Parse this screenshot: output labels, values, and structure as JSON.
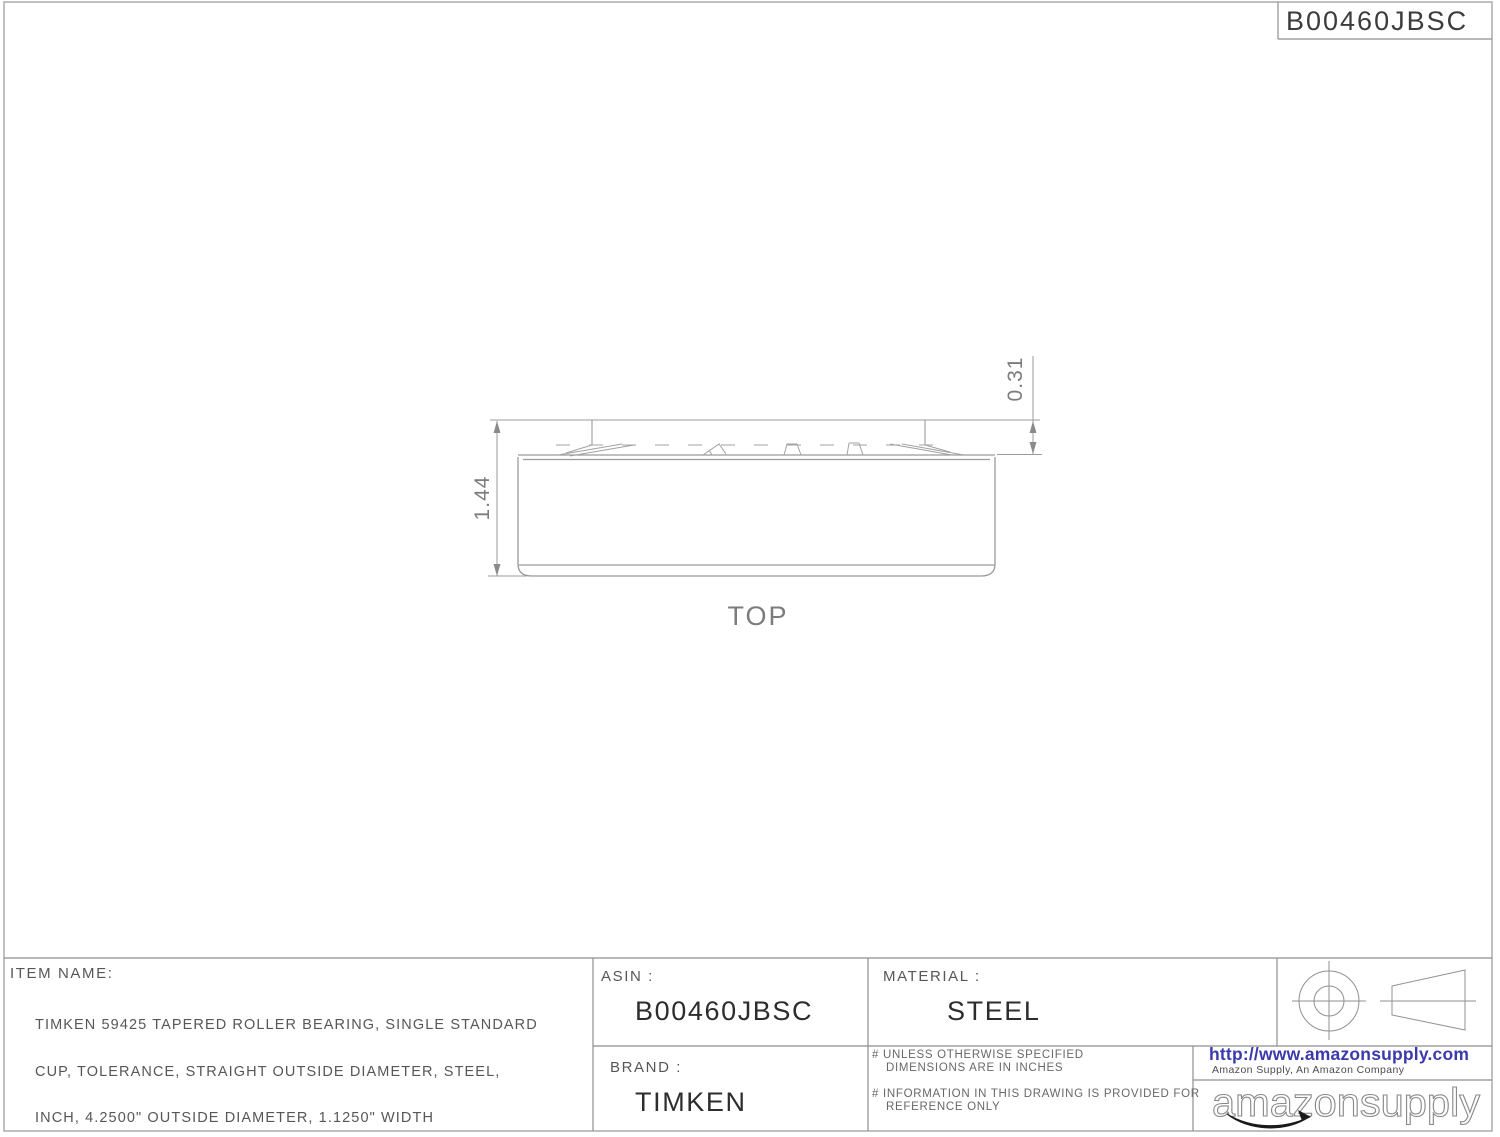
{
  "header": {
    "asin_box": "B00460JBSC"
  },
  "drawing": {
    "view_label": "TOP",
    "dim_total_width": "1.44",
    "dim_cone_width": "0.31"
  },
  "title_block": {
    "item_name_label": "ITEM NAME:",
    "item_name_lines": [
      "TIMKEN 59425 TAPERED ROLLER BEARING, SINGLE STANDARD",
      "CUP, TOLERANCE, STRAIGHT OUTSIDE DIAMETER, STEEL,",
      "INCH, 4.2500\" OUTSIDE DIAMETER, 1.1250\" WIDTH"
    ],
    "asin_label": "ASIN :",
    "asin_value": "B00460JBSC",
    "material_label": "MATERIAL :",
    "material_value": "STEEL",
    "brand_label": "BRAND :",
    "brand_value": "TIMKEN",
    "notes": [
      {
        "line1": "# UNLESS OTHERWISE SPECIFIED",
        "line2": "DIMENSIONS ARE IN INCHES"
      },
      {
        "line1": "# INFORMATION IN THIS DRAWING IS PROVIDED FOR",
        "line2": "REFERENCE ONLY"
      }
    ],
    "url": "http://www.amazonsupply.com",
    "company_line": "Amazon Supply, An Amazon Company",
    "logo_text": "amazonsupply"
  },
  "colors": {
    "url_blue": "#3a3aad",
    "line_gray": "#8e8e8e",
    "drawing_gray": "#9a9a9a",
    "text_dark": "#2d2d2d",
    "swoosh_black": "#1a1a1a"
  }
}
